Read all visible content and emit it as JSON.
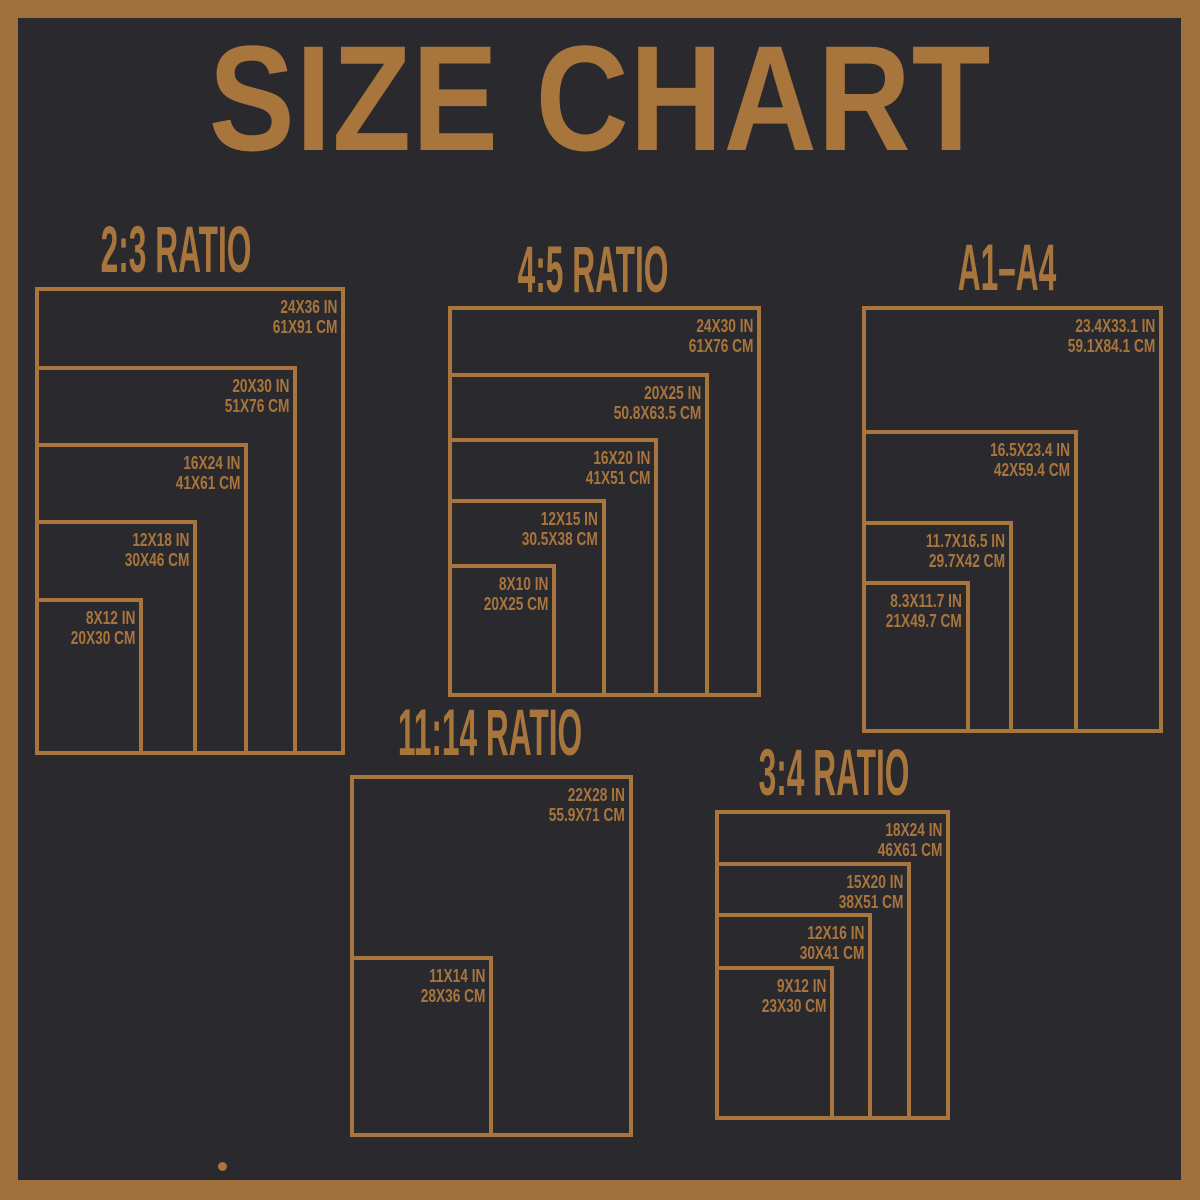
{
  "page": {
    "title": "SIZE CHART"
  },
  "colors": {
    "frame": "#9f6f3d",
    "accent": "#a8753c",
    "background": "#2a292e"
  },
  "groups": [
    {
      "title": "2:3 RATIO",
      "sizes": [
        {
          "inches": "24X36 IN",
          "cm": "61X91 CM"
        },
        {
          "inches": "20X30 IN",
          "cm": "51X76 CM"
        },
        {
          "inches": "16X24 IN",
          "cm": "41X61 CM"
        },
        {
          "inches": "12X18 IN",
          "cm": "30X46 CM"
        },
        {
          "inches": "8X12 IN",
          "cm": "20X30 CM"
        }
      ]
    },
    {
      "title": "4:5 RATIO",
      "sizes": [
        {
          "inches": "24X30 IN",
          "cm": "61X76 CM"
        },
        {
          "inches": "20X25 IN",
          "cm": "50.8X63.5 CM"
        },
        {
          "inches": "16X20 IN",
          "cm": "41X51 CM"
        },
        {
          "inches": "12X15 IN",
          "cm": "30.5X38 CM"
        },
        {
          "inches": "8X10 IN",
          "cm": "20X25 CM"
        }
      ]
    },
    {
      "title": "A1–A4",
      "sizes": [
        {
          "inches": "23.4X33.1 IN",
          "cm": "59.1X84.1 CM"
        },
        {
          "inches": "16.5X23.4 IN",
          "cm": "42X59.4 CM"
        },
        {
          "inches": "11.7X16.5 IN",
          "cm": "29.7X42 CM"
        },
        {
          "inches": "8.3X11.7 IN",
          "cm": "21X49.7 CM"
        }
      ]
    },
    {
      "title": "11:14 RATIO",
      "sizes": [
        {
          "inches": "22X28 IN",
          "cm": "55.9X71 CM"
        },
        {
          "inches": "11X14 IN",
          "cm": "28X36 CM"
        }
      ]
    },
    {
      "title": "3:4 RATIO",
      "sizes": [
        {
          "inches": "18X24 IN",
          "cm": "46X61 CM"
        },
        {
          "inches": "15X20 IN",
          "cm": "38X51 CM"
        },
        {
          "inches": "12X16 IN",
          "cm": "30X41 CM"
        },
        {
          "inches": "9X12 IN",
          "cm": "23X30 CM"
        }
      ]
    }
  ]
}
